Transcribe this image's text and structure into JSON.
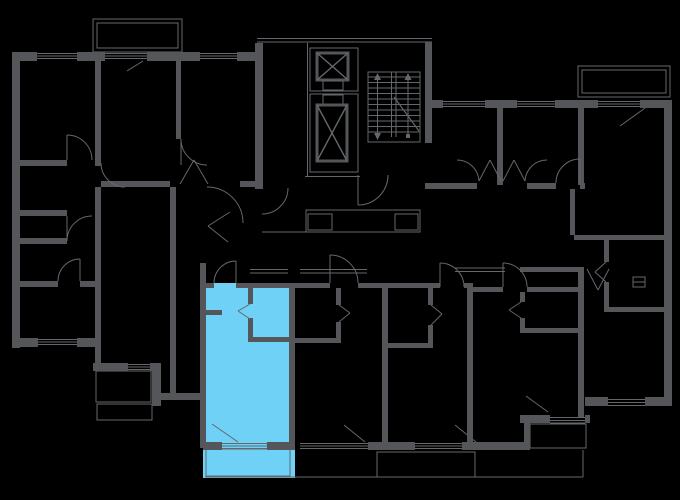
{
  "page": {
    "title": "building-floor-plan"
  },
  "colors": {
    "bg": "#000000",
    "wall": "#54565a",
    "line": "#64676b",
    "highlight": "#6ed1f5"
  },
  "floorplan": {
    "highlighted_unit": {
      "color": "#6ed1f5",
      "location": "bottom-center-left",
      "rooms": [
        "main-room",
        "bathroom",
        "balcony"
      ]
    },
    "core": {
      "elevators": 2,
      "staircase": true
    },
    "clusters": [
      "top-left-apartments",
      "right-apartments",
      "bottom-row-units"
    ],
    "balconies": [
      "top-left",
      "top-right",
      "highlighted-unit",
      "bottom-center",
      "bottom-right"
    ]
  }
}
